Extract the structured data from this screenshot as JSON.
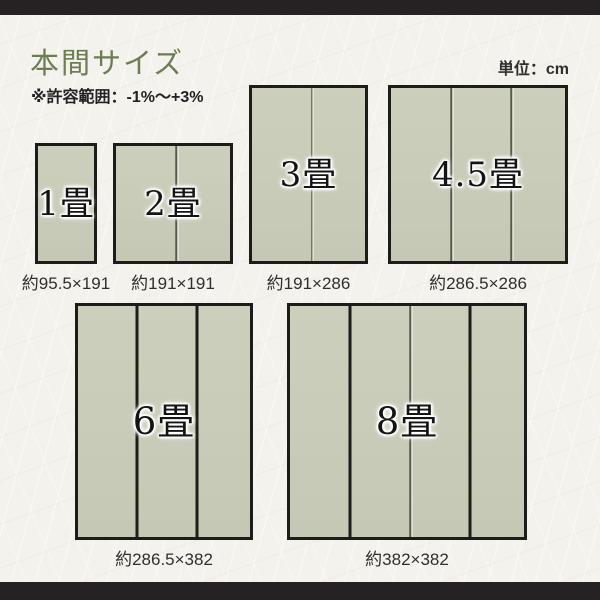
{
  "header": {
    "title": "本間サイズ",
    "tolerance_note": "※許容範囲：-1%〜+3%",
    "unit_label": "単位：cm"
  },
  "colors": {
    "background": "#f4f2ec",
    "frame_bar": "#262223",
    "title_green": "#6d7d53",
    "text_dark": "#2f2f2f",
    "mat_fill": "#c8ccb8",
    "mat_border": "#1e1c19",
    "divider_thin": "#565a4c",
    "divider_thick": "#1e1c19"
  },
  "mats": [
    {
      "id": "1jo",
      "label": "1畳",
      "dimensions": "約95.5×191",
      "size_cm": {
        "width": 95.5,
        "height": 191
      },
      "box": {
        "left": 35,
        "top": 143,
        "width": 62,
        "height": 121
      },
      "dividers": []
    },
    {
      "id": "2jo",
      "label": "2畳",
      "dimensions": "約191×191",
      "size_cm": {
        "width": 191,
        "height": 191
      },
      "box": {
        "left": 113,
        "top": 143,
        "width": 120,
        "height": 121
      },
      "dividers": [
        {
          "x": 60,
          "style": "thin"
        }
      ]
    },
    {
      "id": "3jo",
      "label": "3畳",
      "dimensions": "約191×286",
      "size_cm": {
        "width": 191,
        "height": 286
      },
      "box": {
        "left": 249,
        "top": 85,
        "width": 119,
        "height": 179
      },
      "dividers": [
        {
          "x": 59.5,
          "style": "thin"
        }
      ]
    },
    {
      "id": "4-5jo",
      "label": "4.5畳",
      "dimensions": "約286.5×286",
      "size_cm": {
        "width": 286.5,
        "height": 286
      },
      "box": {
        "left": 388,
        "top": 85,
        "width": 180,
        "height": 179
      },
      "dividers": [
        {
          "x": 60,
          "style": "thin"
        },
        {
          "x": 120,
          "style": "thin"
        }
      ]
    },
    {
      "id": "6jo",
      "label": "6畳",
      "dimensions": "約286.5×382",
      "size_cm": {
        "width": 286.5,
        "height": 382
      },
      "box": {
        "left": 75,
        "top": 303,
        "width": 178,
        "height": 237
      },
      "dividers": [
        {
          "x": 59.3,
          "style": "thick"
        },
        {
          "x": 118.7,
          "style": "thick"
        }
      ]
    },
    {
      "id": "8jo",
      "label": "8畳",
      "dimensions": "約382×382",
      "size_cm": {
        "width": 382,
        "height": 382
      },
      "box": {
        "left": 287,
        "top": 303,
        "width": 240,
        "height": 237
      },
      "dividers": [
        {
          "x": 60,
          "style": "thick"
        },
        {
          "x": 120,
          "style": "thin"
        },
        {
          "x": 180,
          "style": "thick"
        }
      ]
    }
  ]
}
